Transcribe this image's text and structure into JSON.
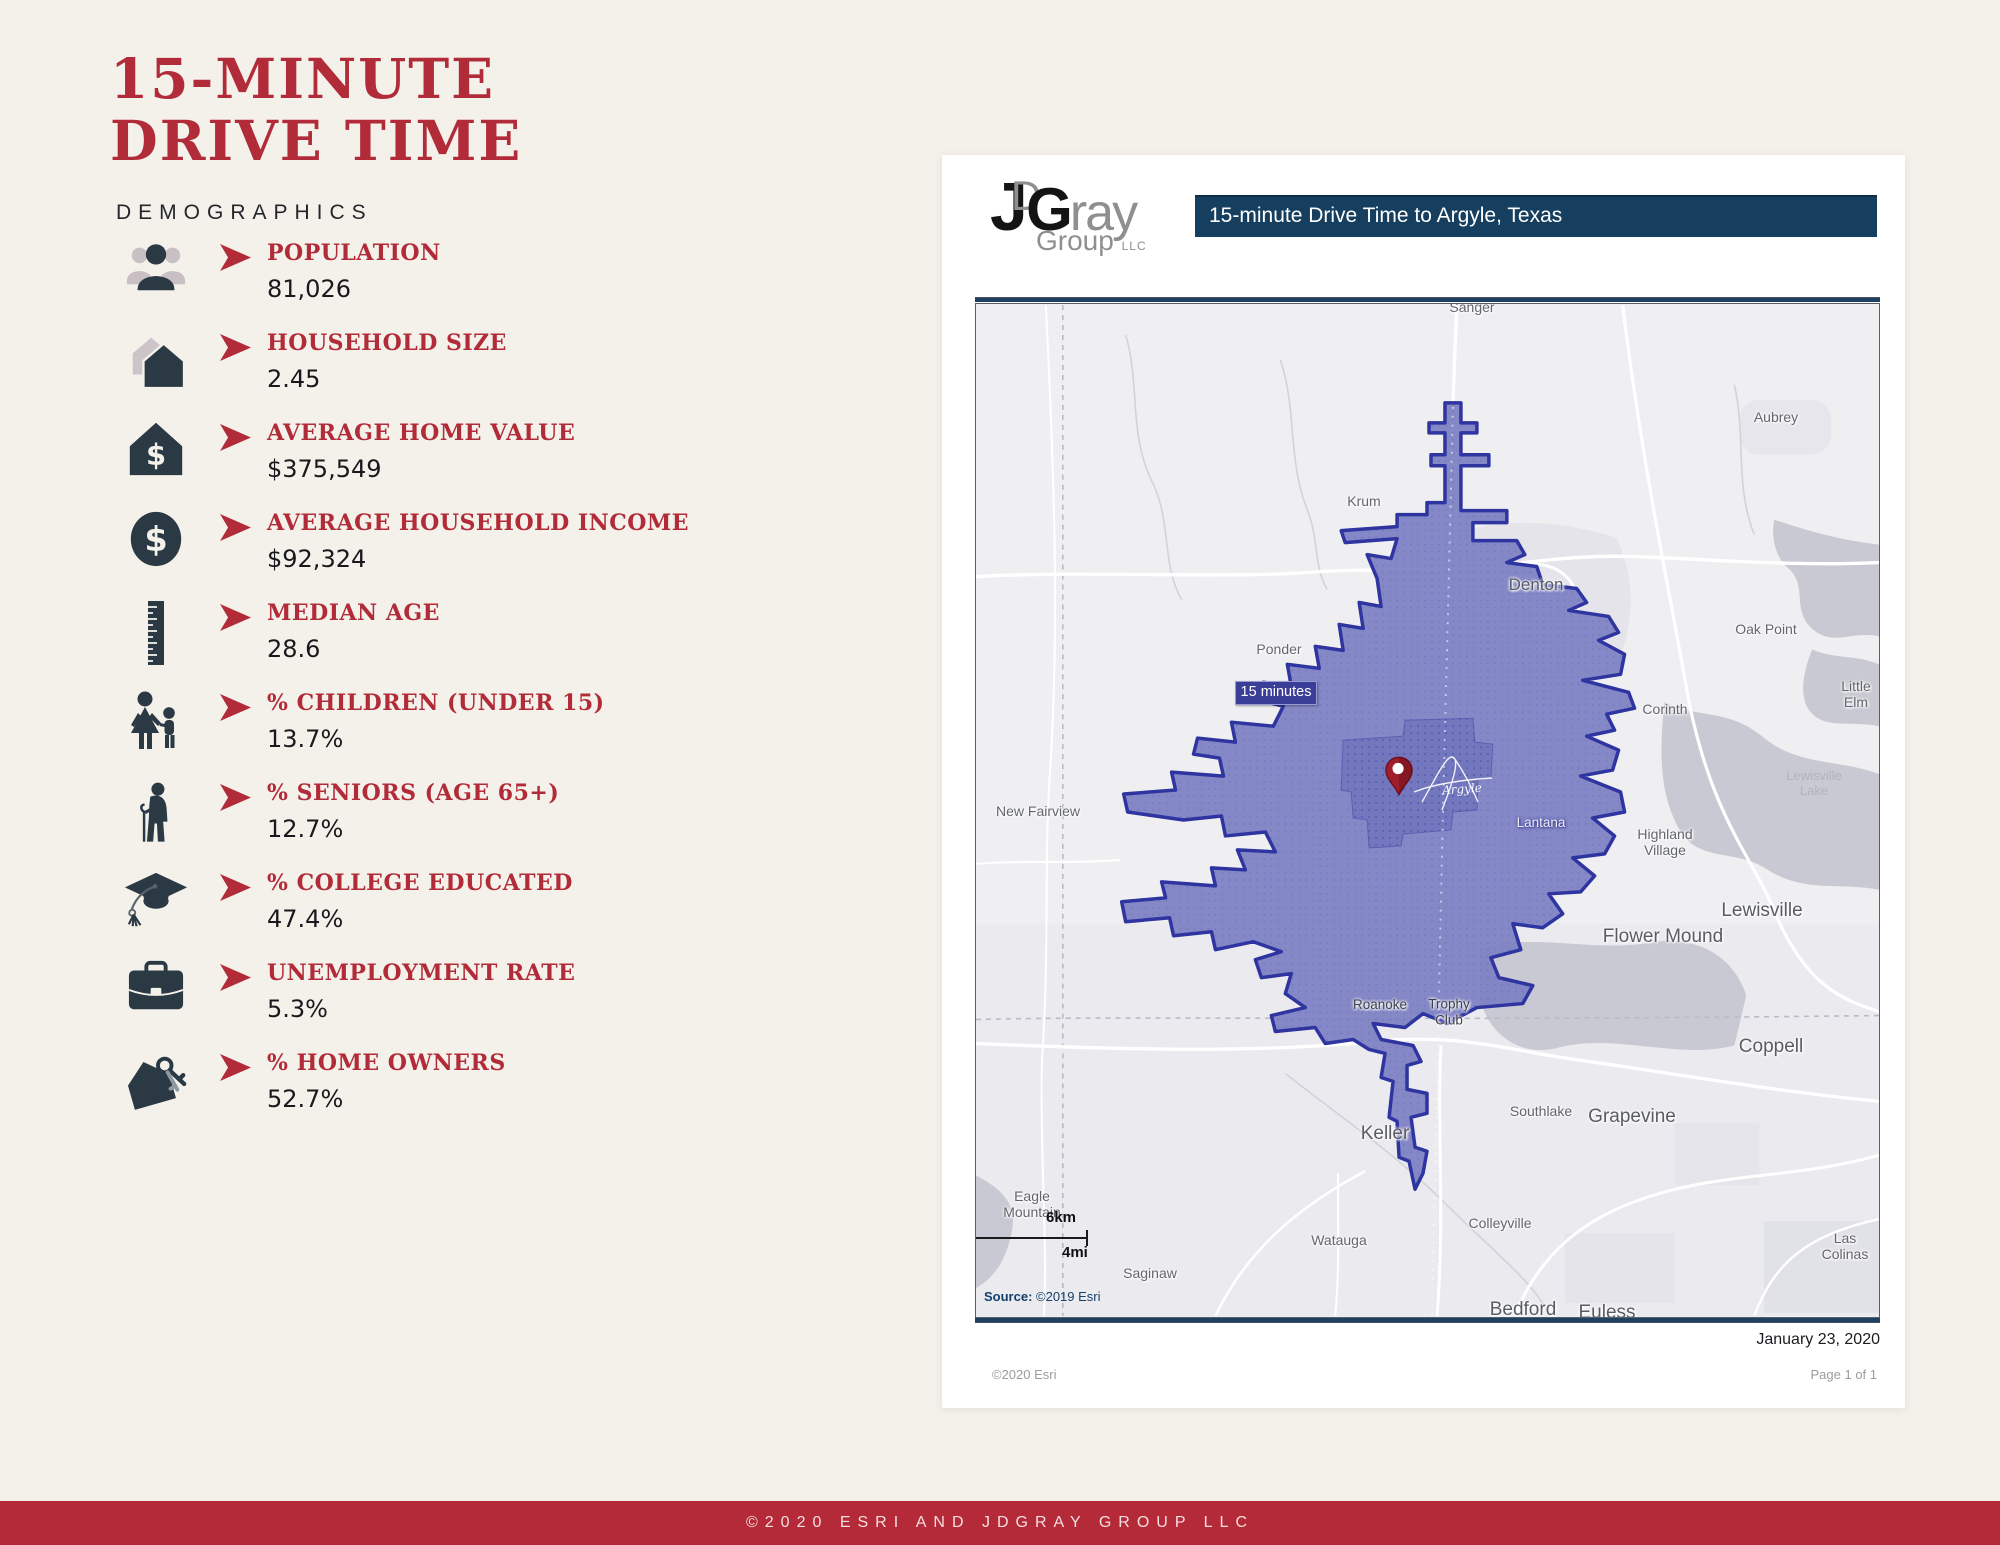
{
  "header": {
    "title_line1": "15-MINUTE",
    "title_line2": "DRIVE TIME",
    "subtitle": "DEMOGRAPHICS"
  },
  "stats": [
    {
      "icon": "people-icon",
      "label": "POPULATION",
      "value": "81,026"
    },
    {
      "icon": "household-icon",
      "label": "HOUSEHOLD SIZE",
      "value": "2.45"
    },
    {
      "icon": "home-value-icon",
      "label": "AVERAGE HOME VALUE",
      "value": "$375,549"
    },
    {
      "icon": "income-icon",
      "label": "AVERAGE HOUSEHOLD INCOME",
      "value": "$92,324"
    },
    {
      "icon": "ruler-icon",
      "label": "MEDIAN AGE",
      "value": "28.6"
    },
    {
      "icon": "children-icon",
      "label": "% CHILDREN (UNDER 15)",
      "value": "13.7%"
    },
    {
      "icon": "seniors-icon",
      "label": "% SENIORS (AGE 65+)",
      "value": "12.7%"
    },
    {
      "icon": "college-icon",
      "label": "% COLLEGE EDUCATED",
      "value": "47.4%"
    },
    {
      "icon": "briefcase-icon",
      "label": "UNEMPLOYMENT RATE",
      "value": "5.3%"
    },
    {
      "icon": "keys-icon",
      "label": "% HOME OWNERS",
      "value": "52.7%"
    }
  ],
  "card": {
    "logo": {
      "j": "J",
      "d": "D",
      "g": "G",
      "ray": "ray",
      "group": "Group",
      "llc": "LLC"
    },
    "banner_title": "15-minute Drive Time to Argyle, Texas",
    "map": {
      "badge": "15 minutes",
      "argyle_label": "Argyle",
      "scale_km": "6km",
      "scale_mi": "4mi",
      "source_prefix": "Source:",
      "source_text": " ©2019 Esri",
      "labels": [
        {
          "text": "Sanger",
          "x": 496,
          "y": 3,
          "cls": "town"
        },
        {
          "text": "Aubrey",
          "x": 800,
          "y": 113,
          "cls": "town"
        },
        {
          "text": "Krum",
          "x": 388,
          "y": 197,
          "cls": "town"
        },
        {
          "text": "Denton",
          "x": 560,
          "y": 281,
          "cls": "city"
        },
        {
          "text": "Oak Point",
          "x": 790,
          "y": 325,
          "cls": "town"
        },
        {
          "text": "Ponder",
          "x": 303,
          "y": 345,
          "cls": "town"
        },
        {
          "text": "Little Elm",
          "x": 880,
          "y": 390,
          "cls": "town"
        },
        {
          "text": "Corinth",
          "x": 689,
          "y": 405,
          "cls": "town"
        },
        {
          "text": "Lewisville\nLake",
          "x": 838,
          "y": 480,
          "cls": "water"
        },
        {
          "text": "New Fairview",
          "x": 62,
          "y": 507,
          "cls": "town"
        },
        {
          "text": "Lantana",
          "x": 565,
          "y": 519,
          "cls": "onpoly-light"
        },
        {
          "text": "Highland\nVillage",
          "x": 689,
          "y": 538,
          "cls": "town"
        },
        {
          "text": "Lewisville",
          "x": 786,
          "y": 607,
          "cls": "big"
        },
        {
          "text": "Flower Mound",
          "x": 687,
          "y": 633,
          "cls": "big"
        },
        {
          "text": "Roanoke",
          "x": 404,
          "y": 701,
          "cls": "onpoly-dark"
        },
        {
          "text": "Trophy\nClub",
          "x": 473,
          "y": 708,
          "cls": "onpoly-dark"
        },
        {
          "text": "Coppell",
          "x": 795,
          "y": 743,
          "cls": "big"
        },
        {
          "text": "Southlake",
          "x": 565,
          "y": 807,
          "cls": "town"
        },
        {
          "text": "Grapevine",
          "x": 656,
          "y": 813,
          "cls": "big"
        },
        {
          "text": "Keller",
          "x": 409,
          "y": 830,
          "cls": "big"
        },
        {
          "text": "Eagle\nMountain",
          "x": 56,
          "y": 900,
          "cls": "town"
        },
        {
          "text": "Colleyville",
          "x": 524,
          "y": 919,
          "cls": "town"
        },
        {
          "text": "Watauga",
          "x": 363,
          "y": 936,
          "cls": "town"
        },
        {
          "text": "Saginaw",
          "x": 174,
          "y": 969,
          "cls": "town"
        },
        {
          "text": "Las Colinas",
          "x": 869,
          "y": 942,
          "cls": "town"
        },
        {
          "text": "Bedford",
          "x": 547,
          "y": 1006,
          "cls": "big"
        },
        {
          "text": "Euless",
          "x": 631,
          "y": 1009,
          "cls": "big"
        }
      ]
    },
    "date": "January 23, 2020",
    "esri_credit": "©2020 Esri",
    "page_num": "Page 1 of 1"
  },
  "footer": {
    "text": "©2020 ESRI AND JDGRAY GROUP LLC"
  },
  "colors": {
    "accent_red": "#b12b38",
    "footer_red": "#b52a38",
    "banner_navy": "#153e5f",
    "icon_ink": "#2b3944",
    "drive_area_fill": "#7e82c4",
    "drive_area_border": "#2e34a0",
    "pin_red": "#a01e2c",
    "page_background": "#f4f1ea"
  }
}
